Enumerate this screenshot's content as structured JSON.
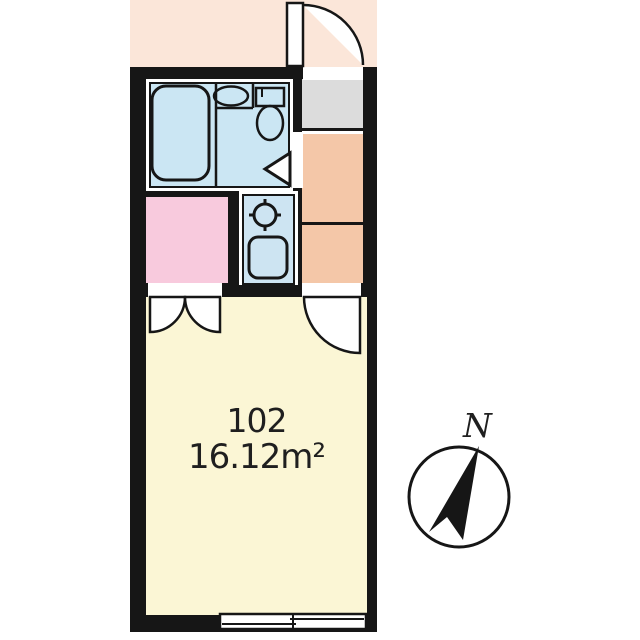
{
  "unit": {
    "number": "102",
    "area": "16.12m²"
  },
  "compass": {
    "label": "N"
  },
  "fixtures": [
    "bathtub",
    "washbasin",
    "toilet",
    "bathroom-door-marker",
    "gas-burner",
    "kitchen-sink",
    "entrance-door",
    "closet-double-door",
    "room-door",
    "sliding-window",
    "compass-needle"
  ],
  "colors": {
    "wall": "#161616",
    "exterior": "#fbe6d9",
    "corridor": "#f4c7a8",
    "bathroom": "#cbe6f3",
    "kitchen": "#cde4f2",
    "closet_room": "#f8cadd",
    "main_room": "#fbf6d5",
    "genkan": "#dcdcdc",
    "text": "#1f1f1f"
  }
}
